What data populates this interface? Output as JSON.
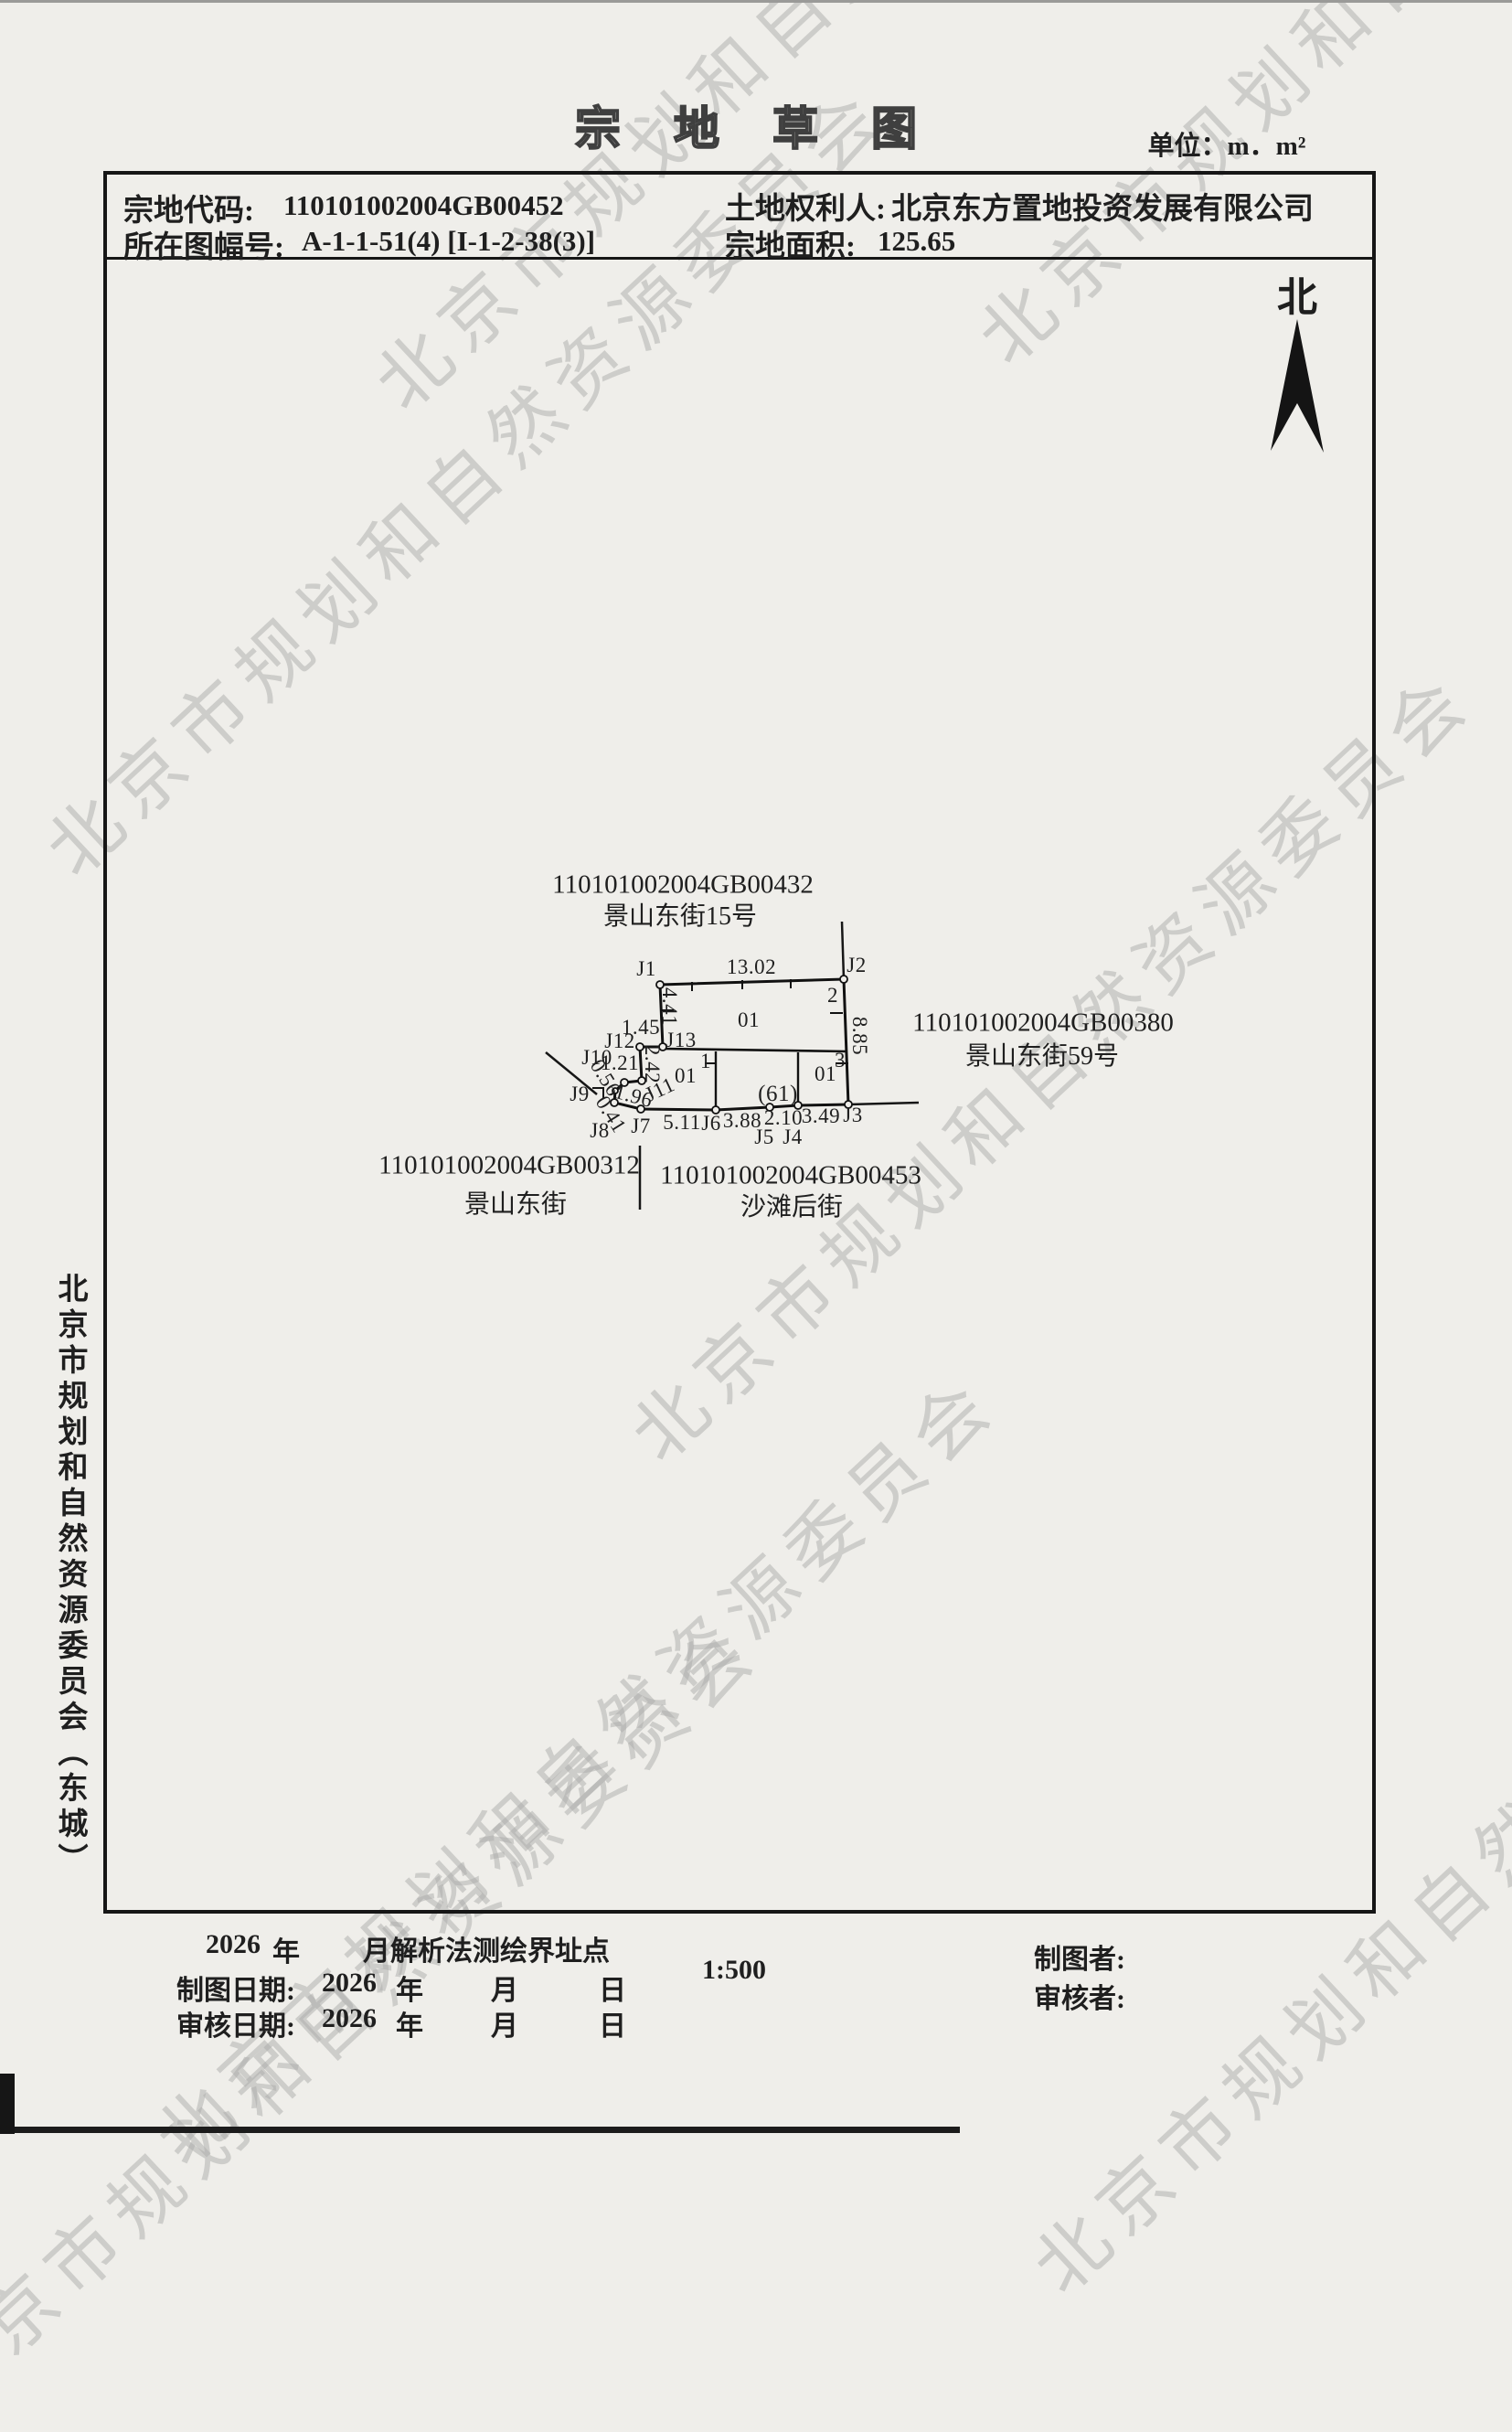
{
  "title": "宗地草图",
  "unit_label": "单位：m．m²",
  "north_label": "北",
  "watermark": {
    "text": "北京市规划和自然资源委员会"
  },
  "side_text": "北京市规划和自然资源委员会（东城）",
  "header": {
    "parcel_code_label": "宗地代码:",
    "parcel_code": "110101002004GB00452",
    "map_sheet_label": "所在图幅号:",
    "map_sheet": "A-1-1-51(4) [I-1-2-38(3)]",
    "owner_label": "土地权利人:",
    "owner": "北京东方置地投资发展有限公司",
    "area_label": "宗地面积:",
    "area": "125.65"
  },
  "diagram": {
    "points": {
      "j1": "J1",
      "j2": "J2",
      "j3": "J3",
      "j4": "J4",
      "j5": "J5",
      "j6": "J6",
      "j7": "J7",
      "j8": "J8",
      "j9": "J9",
      "j10": "J10",
      "j11": "J11",
      "j12": "J12",
      "j13": "J13"
    },
    "meas": {
      "m1302": "13.02",
      "m885": "8.85",
      "m441": "4.41",
      "m242": "2.42",
      "m145": "1.45",
      "m121": "1.21",
      "m056": "0.56",
      "m041": "0.41",
      "m196": "1.96",
      "m511": "5.11",
      "m388": "3.88",
      "m210": "2.10",
      "m349": "3.49"
    },
    "bld": {
      "n1": "1",
      "n2": "2",
      "n3": "3",
      "b01a": "01",
      "b01b": "01",
      "b01c": "01",
      "b61": "(61)"
    },
    "neighbors": {
      "north": {
        "code": "110101002004GB00432",
        "name": "景山东街15号"
      },
      "east": {
        "code": "110101002004GB00380",
        "name": "景山东街59号"
      },
      "southwest": {
        "code": "110101002004GB00312",
        "name": "景山东街"
      },
      "south": {
        "code": "110101002004GB00453",
        "name": "沙滩后街"
      }
    }
  },
  "footer": {
    "survey_year": "2026",
    "year_char": "年",
    "month_char": "月",
    "day_char": "日",
    "survey_method": "月解析法测绘界址点",
    "scale": "1:500",
    "draw_date_label": "制图日期:",
    "draw_year": "2026",
    "review_date_label": "审核日期:",
    "review_year": "2026",
    "drafter_label": "制图者:",
    "reviewer_label": "审核者:"
  }
}
